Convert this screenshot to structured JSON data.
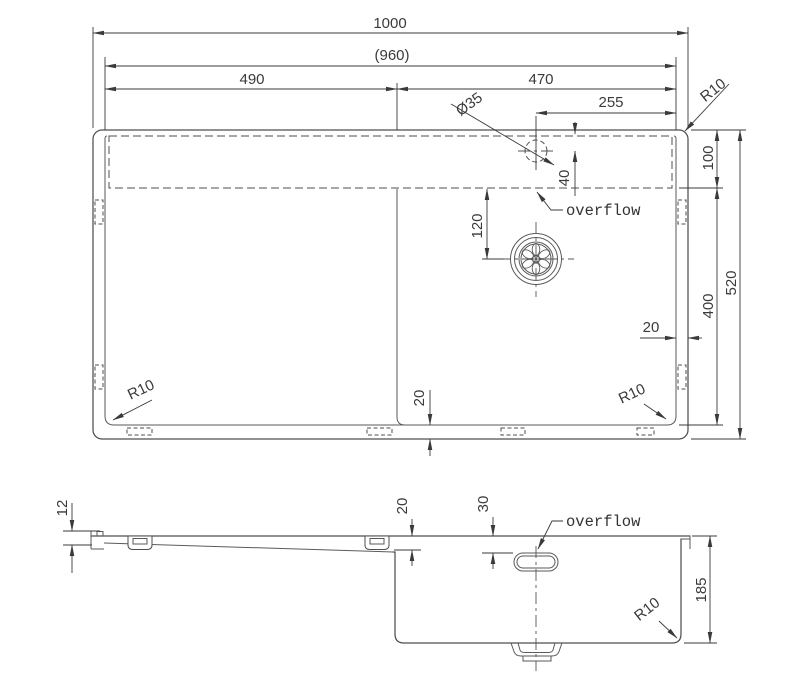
{
  "drawing_type": "sink-dimension-drawing",
  "colors": {
    "line": "#4f4f4f",
    "dimension": "#3a3a3a",
    "background": "#ffffff"
  },
  "top_view": {
    "dim_overall_width": "1000",
    "dim_rim_width": "(960)",
    "dim_drainboard": "490",
    "dim_bowl_section": "470",
    "dim_tap_offset": "255",
    "dim_tap_diameter": "Ø35",
    "radius_top_right": "R10",
    "dim_ledge": "100",
    "dim_bowl_depth": "400",
    "dim_overall_depth": "520",
    "dim_rim_gap_right": "20",
    "dim_rim_gap_bottom": "20",
    "dim_tap_from_top": "40",
    "dim_drain_from_ledge": "120",
    "radius_bottom_left": "R10",
    "radius_bottom_right": "R10",
    "overflow_label": "overflow"
  },
  "side_view": {
    "dim_rim_height": "12",
    "dim_board_drop": "20",
    "dim_overflow_from_top": "30",
    "overflow_label": "overflow",
    "dim_bowl_depth": "185",
    "radius_bottom": "R10"
  }
}
